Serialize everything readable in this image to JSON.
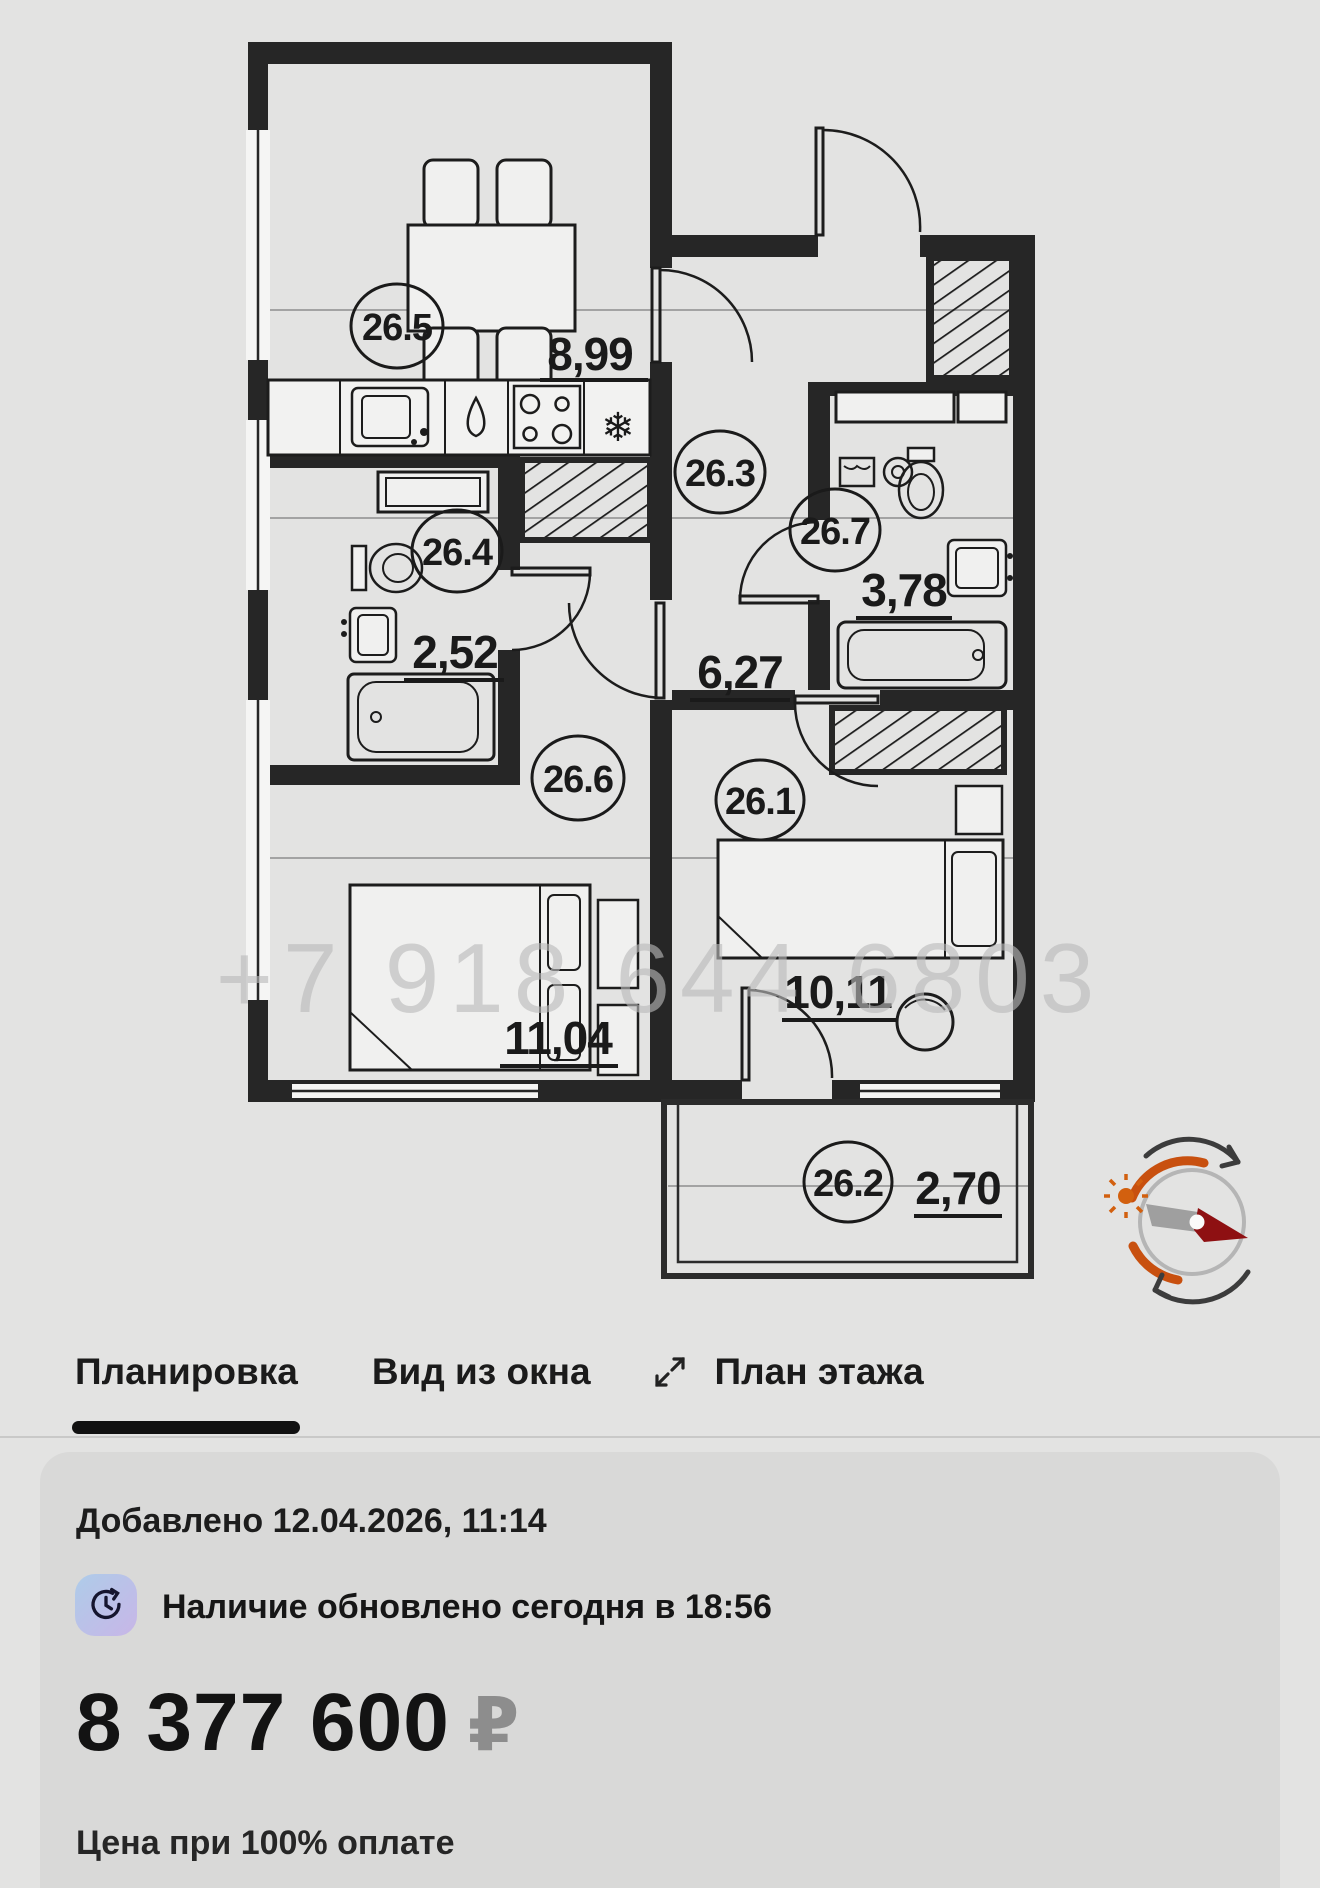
{
  "floor_plan": {
    "watermark": "+7 918 644 6803",
    "rooms": [
      {
        "id": "26.5",
        "area": "8,99"
      },
      {
        "id": "26.4",
        "area": "2,52"
      },
      {
        "id": "26.3",
        "area": "6,27"
      },
      {
        "id": "26.7",
        "area": "3,78"
      },
      {
        "id": "26.6",
        "area": "11,04"
      },
      {
        "id": "26.1",
        "area": "10,11"
      },
      {
        "id": "26.2",
        "area": "2,70"
      }
    ],
    "icons": {
      "fridge_snowflake": "❄"
    },
    "compass_colors": {
      "arc_orange": "#c8500f",
      "needle_red": "#8e1012",
      "ring_gray": "#b5b5b5"
    }
  },
  "tabs": {
    "layout": "Планировка",
    "window_view": "Вид из окна",
    "floor_plan_tab": "План этажа"
  },
  "card": {
    "added": "Добавлено 12.04.2026, 11:14",
    "availability": "Наличие обновлено сегодня в 18:56",
    "price": "8 377 600",
    "currency": "₽",
    "note": "Цена при 100% оплате"
  }
}
